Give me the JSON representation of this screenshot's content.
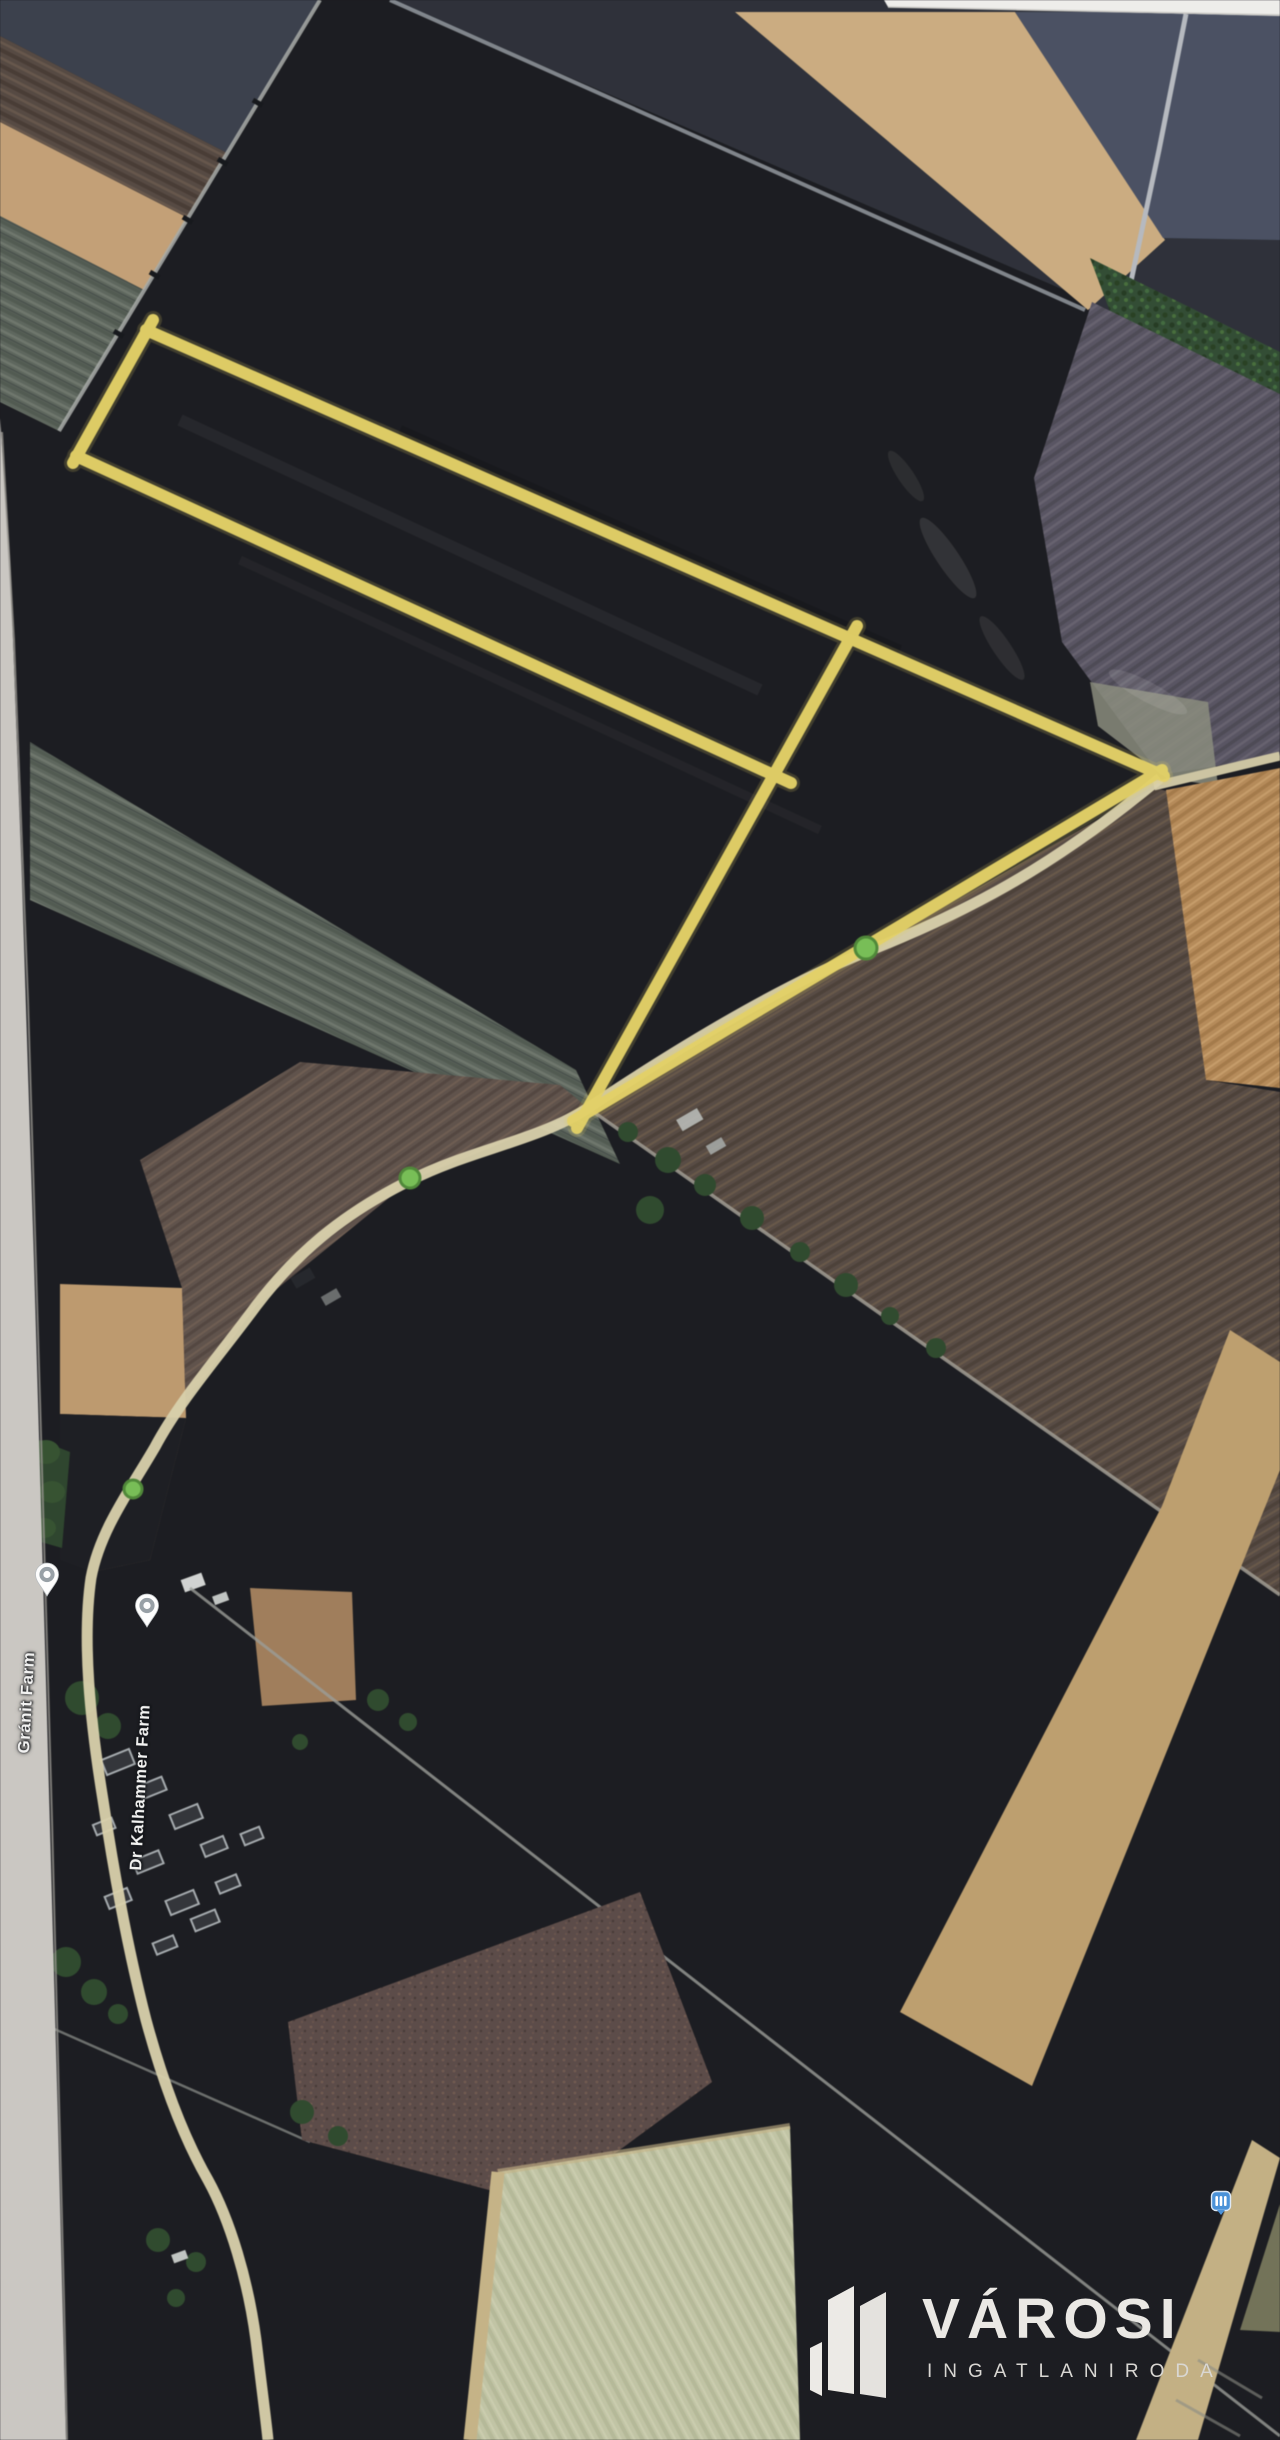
{
  "map": {
    "labels": [
      {
        "id": "granit-farm",
        "text": "Gránit Farm"
      },
      {
        "id": "kalhammer-farm",
        "text": "Dr Kalhammer Farm"
      }
    ],
    "pins": [
      {
        "for": "granit-farm",
        "style": "white-poi-pin"
      },
      {
        "for": "kalhammer-farm",
        "style": "white-poi-pin"
      }
    ],
    "transit_marker": {
      "color": "#4b92d8"
    },
    "annotation": {
      "outline_color": "#e8d45f",
      "shapes": [
        "narrow-strip-parcel",
        "triangle-parcel"
      ]
    },
    "road_color": "#dcd3ab",
    "tree_marker_color": "#74c24f"
  },
  "watermark": {
    "brand": "VÁROSI",
    "subtitle": "INGATLANIRODA",
    "text_color": "#eae8e4"
  },
  "photo": {
    "border_color": "#ccc9c4",
    "background": "#191a1f"
  }
}
